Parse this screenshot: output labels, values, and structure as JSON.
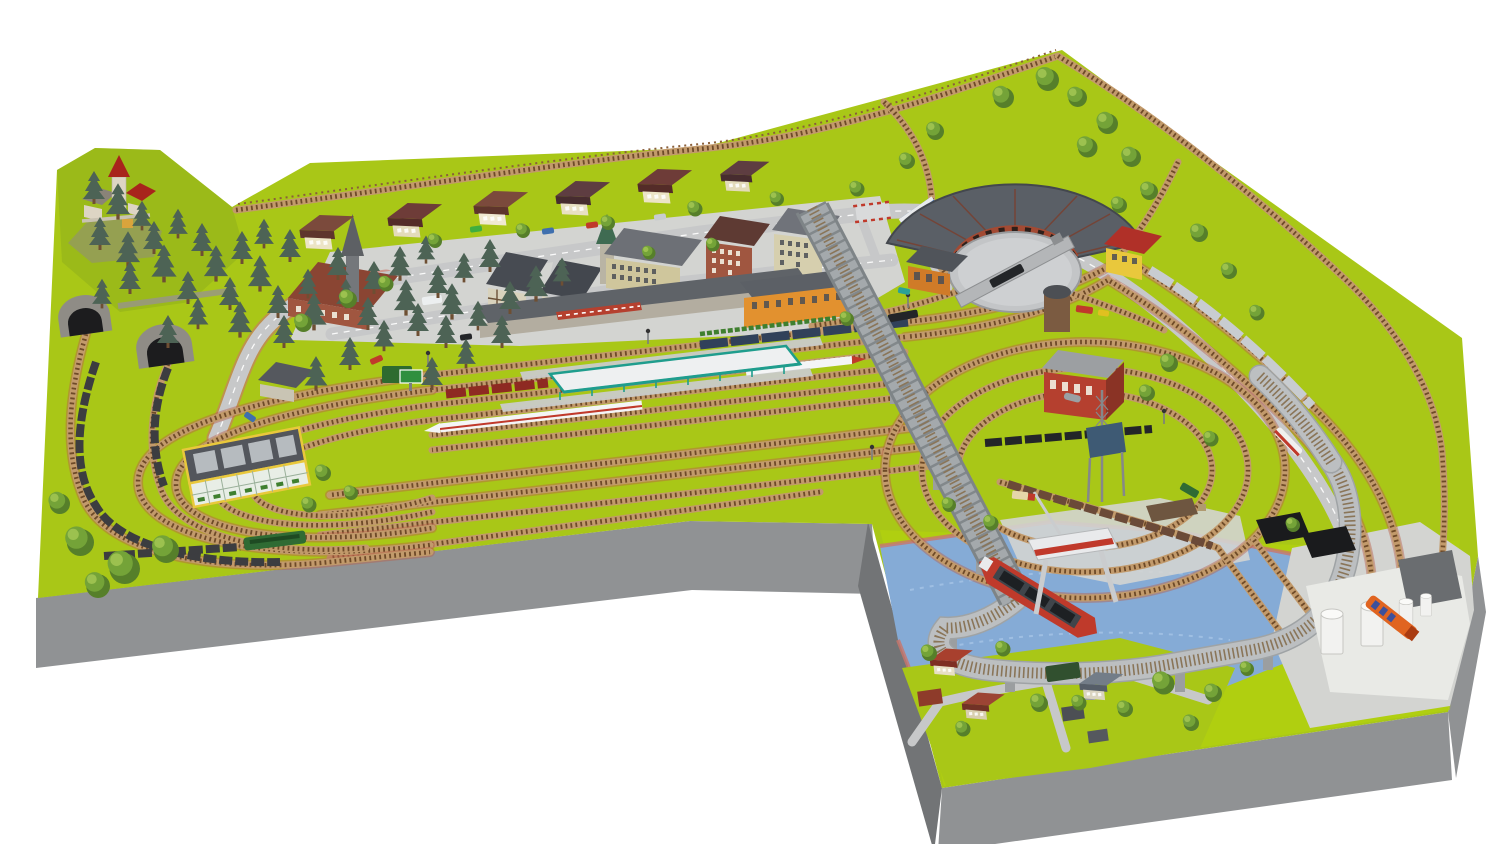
{
  "canvas": {
    "width": 1500,
    "height": 844,
    "viewBox": "0 0 1500 844",
    "background": "#ffffff"
  },
  "scene": {
    "kind": "model-railway-layout-3d-render",
    "board": {
      "shape": "l-shaped-baseboard",
      "sections": [
        "main-board",
        "harbor-annex"
      ]
    },
    "objects": [
      "castle-hill",
      "pine-forest",
      "tunnel-portal-left",
      "tunnel-portal-right",
      "suburban-house-row",
      "town-church-with-spire",
      "half-timbered-houses",
      "apartment-blocks",
      "station-forecourt",
      "main-station-building",
      "orange-station-house",
      "platform-canopy",
      "platforms",
      "ice-train",
      "express-coaches",
      "red-locomotive-train",
      "freight-trains",
      "market-hall-glass-roof",
      "left-return-loops",
      "goods-yard",
      "truss-bridge",
      "elevated-loop",
      "spiral-tracks",
      "red-brick-depot",
      "coaling-tower",
      "roundhouse",
      "turntable",
      "water-tower",
      "steam-locomotives",
      "blue-railbus",
      "silver-train",
      "harbor-basin",
      "cargo-ship",
      "gantry-crane",
      "coal-piles",
      "tank-farm",
      "tanker-truck",
      "quay-sidings",
      "village-houses",
      "roads",
      "cars-and-trucks",
      "deciduous-trees",
      "level-crossing",
      "fence"
    ]
  },
  "colors": {
    "background": "#ffffff",
    "grass": "#a9c717",
    "grass_bright": "#b6d30c",
    "grass_dark": "#8fae1b",
    "board_side": "#909294",
    "board_side_dark": "#727476",
    "water": "#85abd6",
    "water_light": "#aac7e8",
    "harbor_edge": "#c9766a",
    "plaza": "#d3d4d1",
    "road": "#c7c8c9",
    "road_dark": "#b0b1b3",
    "ballast": "#c29a6b",
    "tie": "#6e4a28",
    "track_edge": "#b8604a",
    "elevated": "#bcbfc1",
    "bridge": "#a4a9ac",
    "bridge_dark": "#7e8487",
    "pier": "#9b9ea0",
    "pine": "#4d6355",
    "trunk": "#6e4f33",
    "tree": "#74a338",
    "tree_dark": "#567f2a",
    "tree_light": "#9cc14f",
    "station_teal": "#1f9d8d",
    "canopy_white": "#eef0f1",
    "platform": "#c9cbc9",
    "stone": "#8f8c86",
    "tunnel_dark": "#1c1c1e",
    "castle_wall": "#ddd5c4",
    "castle_roof": "#a8241c",
    "wall_brick": "#a05640",
    "wall_beige": "#cfc69c",
    "wall_orange": "#e2912f",
    "wall_yellow": "#e9c83c",
    "roof_gray": "#5f6368",
    "roundhouse_roof": "#5a5f66",
    "roundhouse_wall": "#a34a33",
    "turntable": "#ced0d2",
    "water_tower": "#7b5b41",
    "coal": "#1a1b1d",
    "ship_hull": "#bf3a2b",
    "ship_deck": "#40454b",
    "crane_white": "#e9eaec",
    "crane_red": "#c0392b",
    "tank_white": "#f2f2f0",
    "truck_orange": "#e06420",
    "ice_white": "#f4f5f6",
    "ice_red": "#c0392b",
    "coach_blue": "#31415a",
    "freight_dark": "#3c3d40",
    "loco_black": "#232528",
    "loco_red": "#8e2a22",
    "railbus_blue": "#3f6fae",
    "silver": "#c8ccd0",
    "green_loco": "#2f6b33"
  }
}
